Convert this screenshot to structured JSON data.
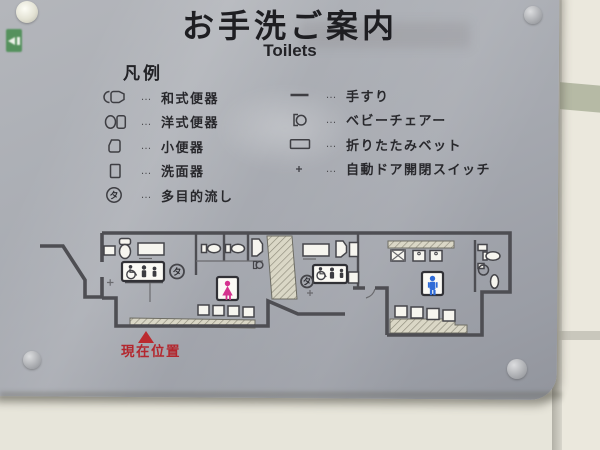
{
  "sign": {
    "title": "お手洗ご案内",
    "subtitle": "Toilets",
    "legend": {
      "heading": "凡例",
      "dots": "…",
      "left": [
        {
          "label": "和式便器"
        },
        {
          "label": "洋式便器"
        },
        {
          "label": "小便器"
        },
        {
          "label": "洗面器"
        },
        {
          "label": "多目的流し"
        }
      ],
      "right": [
        {
          "label": "手すり"
        },
        {
          "label": "ベビーチェアー"
        },
        {
          "label": "折りたたみベット"
        },
        {
          "label": "自動ドア開閉スイッチ"
        }
      ]
    },
    "map": {
      "current_location": "現在位置",
      "multipurpose_mark": "タ"
    },
    "colors": {
      "panel_gray": "#a5a8af",
      "wall_cream": "#e7e5da",
      "women_pink": "#d5338f",
      "men_blue": "#2f6bd7",
      "marker_red": "#bb2a2e",
      "exit_sign_green": "#55915d"
    }
  }
}
